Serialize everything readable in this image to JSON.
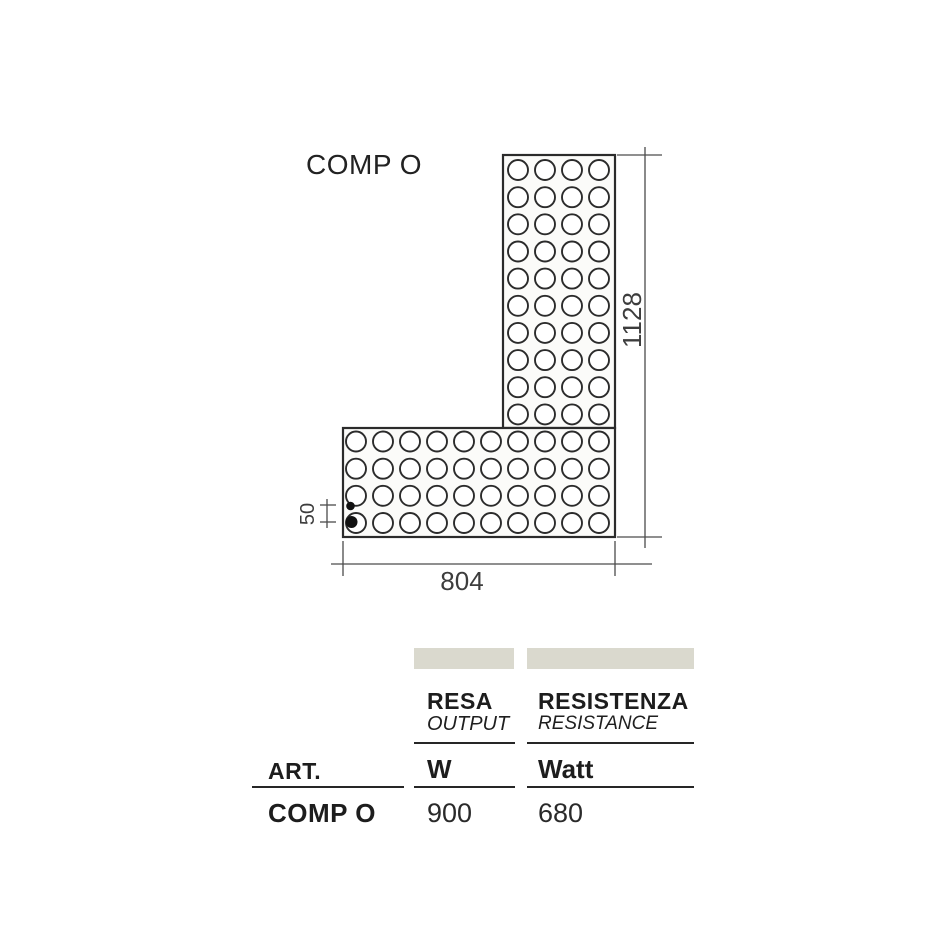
{
  "diagram": {
    "label": "COMP O",
    "dim_height": "1128",
    "dim_width": "804",
    "dim_pitch": "50",
    "grid": {
      "columns": 10,
      "rows_total": 14,
      "vertical_arm_columns": 4,
      "vertical_only_rows": 10,
      "shared_rows": 4
    },
    "colors": {
      "outline": "#2b2b2b",
      "fill": "#fbfbf9",
      "dimension_line": "#4c4c4c",
      "dot": "#111111"
    }
  },
  "table": {
    "art_header": "ART.",
    "header_bar_color": "#dad9ce",
    "ink_color": "#1d1d1d",
    "columns": [
      {
        "title": "RESA",
        "subtitle": "OUTPUT",
        "unit": "W"
      },
      {
        "title": "RESISTENZA",
        "subtitle": "RESISTANCE",
        "unit": "Watt"
      }
    ],
    "row": {
      "art": "COMP O",
      "output_w": "900",
      "resistance_watt": "680"
    }
  }
}
